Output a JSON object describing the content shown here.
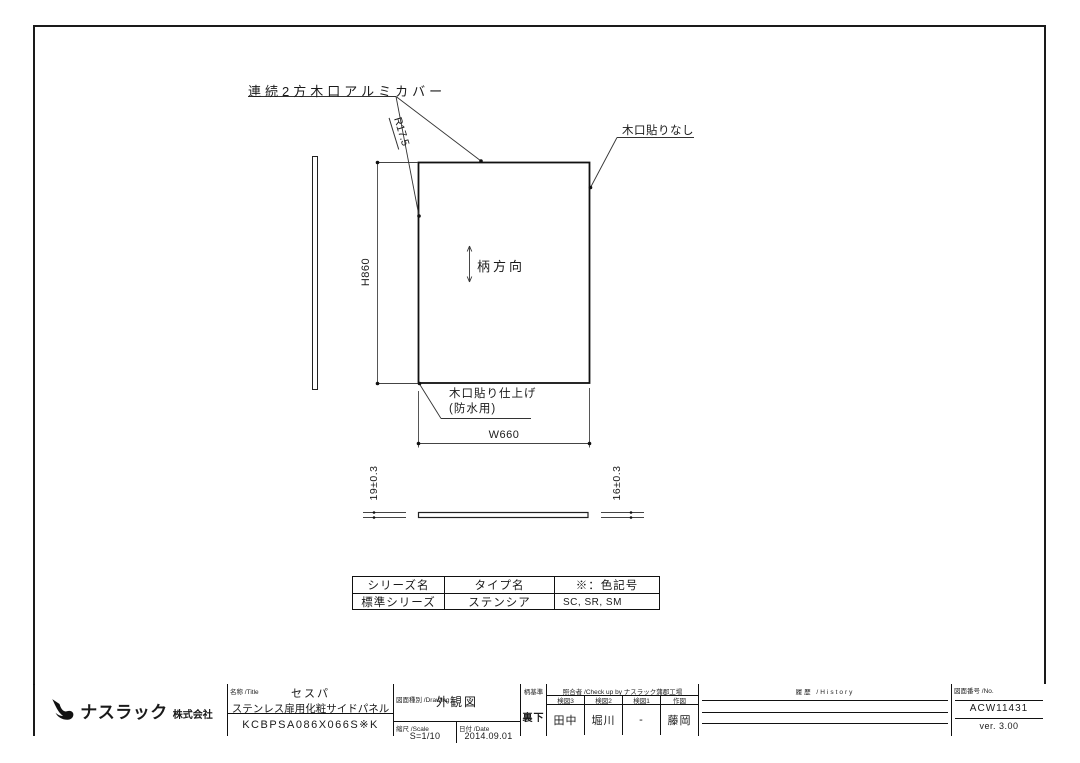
{
  "colors": {
    "line": "#1a1a1a",
    "background": "#ffffff"
  },
  "drawing": {
    "annotations": {
      "edge_cover": "連続2方木口アルミカバー",
      "radius": "R17.5",
      "no_edge_banding": "木口貼りなし",
      "grain_direction": "柄方向",
      "edge_finish_line1": "木口貼り仕上げ",
      "edge_finish_line2": "(防水用)"
    },
    "dimensions": {
      "height": "H860",
      "width": "W660",
      "thickness_left": "19±0.3",
      "thickness_right": "16±0.3"
    }
  },
  "spec_table": {
    "headers": [
      "シリーズ名",
      "タイプ名",
      "※：色記号"
    ],
    "row": [
      "標準シリーズ",
      "ステンシア",
      "SC, SR, SM"
    ]
  },
  "title_block": {
    "company": {
      "name": "ナスラック",
      "suffix": "株式会社"
    },
    "title": {
      "label": "名称 /Title",
      "line1": "セスパ",
      "line2": "ステンレス扉用化粧サイドパネル",
      "code": "KCBPSA086X066S※K"
    },
    "drawing_type": {
      "label": "図面種別 /Drawing",
      "value": "外観図"
    },
    "scale": {
      "label": "縮尺 /Scale",
      "value": "S=1/10"
    },
    "date": {
      "label": "日付 /Date",
      "value": "2014.09.01"
    },
    "pattern_ref": {
      "label": "柄基準",
      "value": "裏下"
    },
    "checkup": {
      "label": "照合者 /Check up by ナスラック蒲郡工場",
      "columns": [
        {
          "label": "検図3",
          "value": "田中"
        },
        {
          "label": "検図2",
          "value": "堀川"
        },
        {
          "label": "検図1",
          "value": "-"
        },
        {
          "label": "作図",
          "value": "藤岡"
        }
      ]
    },
    "history": {
      "label": "履歴 /History"
    },
    "number": {
      "label": "図面番号 /No.",
      "value": "ACW11431",
      "version": "ver. 3.00"
    }
  }
}
